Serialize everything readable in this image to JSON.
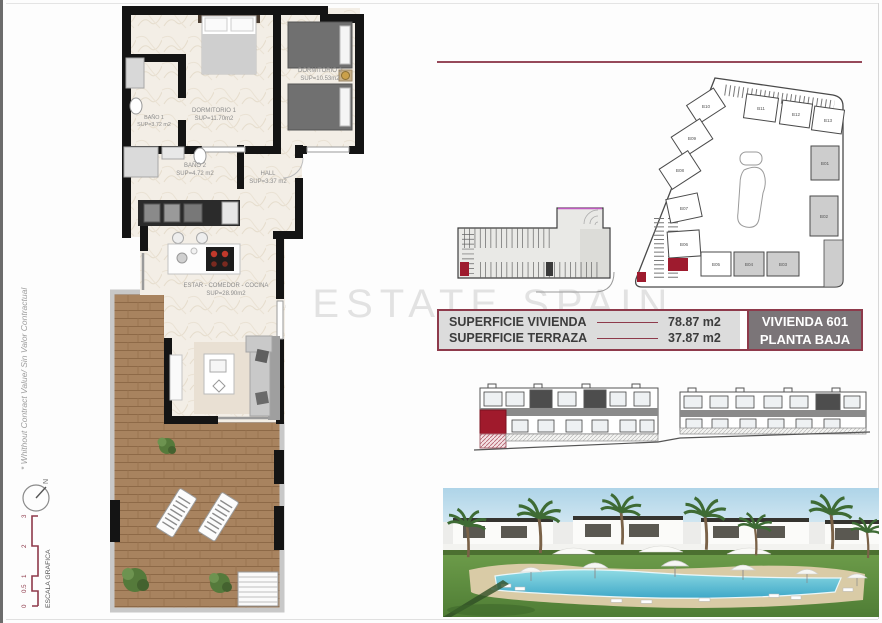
{
  "page": {
    "watermark": "- ESTATE SPAIN",
    "disclaimer": "* Whithout Contract Value/ Sin Valor Contractual"
  },
  "floor_plan": {
    "rooms": [
      {
        "name": "BAÑO 1",
        "sup": "SUP=3.72 m2"
      },
      {
        "name": "DORMITORIO 1",
        "sup": "SUP=11.70m2"
      },
      {
        "name": "DORMITORIO 2",
        "sup": "SUP=10.53m2"
      },
      {
        "name": "BAÑO 2",
        "sup": "SUP=4.72 m2"
      },
      {
        "name": "HALL",
        "sup": "SUP=3.37 m2"
      },
      {
        "name": "ESTAR - COMEDOR - COCINA",
        "sup": "SUP=28.90m2"
      }
    ]
  },
  "site_plan": {
    "buildings": [
      "B01",
      "B02",
      "B03",
      "B04",
      "B05",
      "B06",
      "B07",
      "B08",
      "B09",
      "B10",
      "B11",
      "B12",
      "B13"
    ]
  },
  "summary_table": {
    "rows": [
      {
        "label": "SUPERFICIE VIVIENDA",
        "value": "78.87 m2"
      },
      {
        "label": "SUPERFICIE TERRAZA",
        "value": "37.87 m2"
      }
    ],
    "unit": {
      "line1": "VIVIENDA 601",
      "line2": "PLANTA BAJA"
    }
  },
  "scale_bar": {
    "label": "ESCALA GRAFICA",
    "ticks": [
      "0",
      "0.5",
      "1",
      "2",
      "3"
    ]
  },
  "compass": {
    "north": "N"
  },
  "colors": {
    "accent": "#8e3a4b",
    "highlight_red": "#9e1b2e",
    "table_left_bg": "#dcdcdc",
    "table_right_bg": "#7b7578",
    "deck_wood": "#a8835f"
  }
}
